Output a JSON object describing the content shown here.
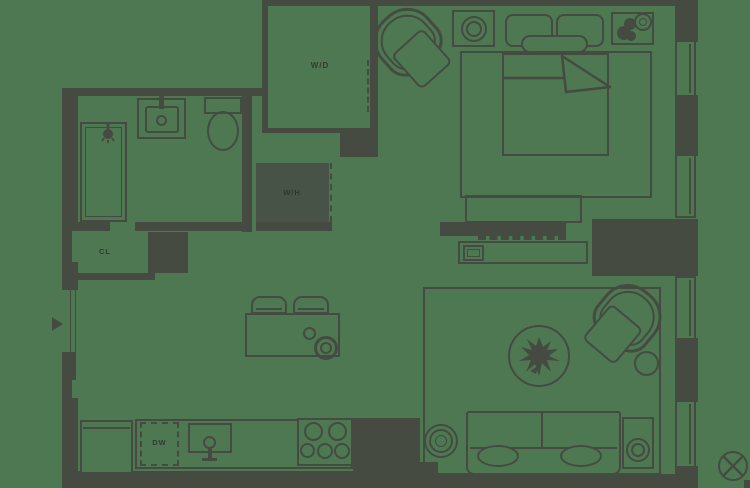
{
  "page": {
    "type": "apartment-floor-plan"
  },
  "colors": {
    "bg": "#4d7852",
    "ln": "#454b41",
    "lab": "#333a30",
    "wh_fill": "#475347",
    "wh_lab": "#2f362c"
  },
  "labels": {
    "washer_dryer": "W/D",
    "water_heater": "W/H",
    "closet": "CL",
    "dishwasher": "DW"
  },
  "icons": {
    "entry-arrow-icon": "solid right-pointing triangle at entry door",
    "shower-head-icon": "shower head with spray",
    "sink-faucet-icon": "faucet ring and stem",
    "toilet-icon": "tank and bowl",
    "table-lamp-icon": "concentric rings",
    "potted-plant-icon": "dark leafy blob",
    "plant-star-icon": "spiky plant on round coffee table",
    "burner-icon": "cooktop burner circle",
    "circled-x-icon": "circle crossed by X"
  }
}
